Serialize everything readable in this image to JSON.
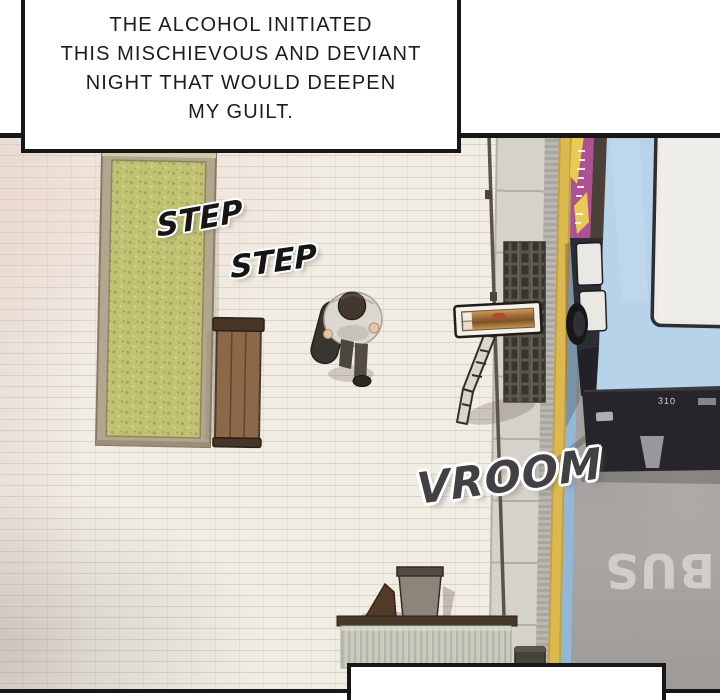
{
  "narration_top": {
    "line1": "THE ALCOHOL INITIATED",
    "line2": "THIS MISCHIEVOUS AND DEVIANT",
    "line3": "NIGHT THAT WOULD DEEPEN",
    "line4": "MY GUILT."
  },
  "sfx": {
    "step_first": "STEP",
    "step_second": "STEP",
    "vroom": "VROOM"
  },
  "road": {
    "lane_marking": "BUS"
  },
  "bus": {
    "rear_route_number": "310"
  },
  "narration_bottom": {
    "text": ""
  },
  "colors": {
    "brick_pavement": "#f1ede5",
    "grass": "#c2c275",
    "planter_frame": "#b2a68e",
    "bench_wood": "#8b6848",
    "asphalt": "#a3a09d",
    "lane_yellow": "#dcb84e",
    "lane_blue": "#92b8d8",
    "bus_roof_blue": "#b7d3e9",
    "bus_ad_magenta": "#ad5094",
    "bus_ad_yellow": "#e8cb52",
    "sfx_ink": "#161616",
    "panel_border": "#171717",
    "road_marking": "#d4d0cb"
  }
}
